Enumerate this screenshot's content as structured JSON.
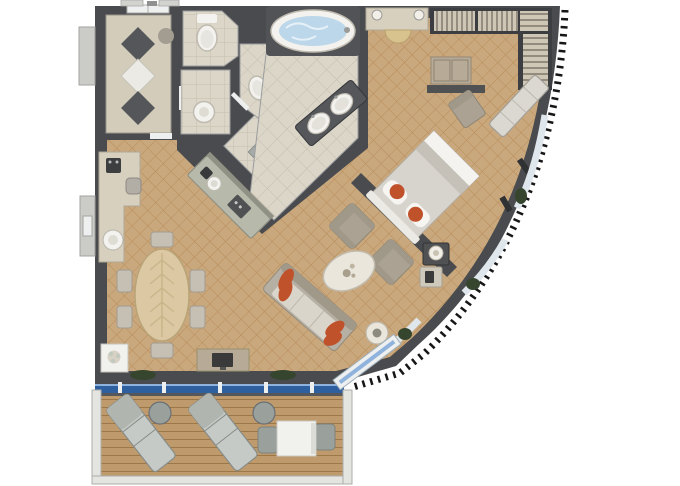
{
  "page": {
    "kind": "cruise-suite-floor-plan",
    "background": "#ffffff"
  },
  "colors": {
    "wall": "#494b4e",
    "wallDark": "#3c3e41",
    "carpet": "#c9a87e",
    "carpetLine": "#b5854d",
    "tile": "#dbd6c8",
    "tileLine": "#c4beae",
    "hallFloor": "#d3ccba",
    "diamondDark": "#54565a",
    "diamondLight": "#eceae4",
    "fixture": "#f3f2ee",
    "fixtureEdge": "#bfbbb0",
    "water": "#bcd7e9",
    "waterSwirl": "#e9f3f9",
    "counterBar": "#b7b9ab",
    "counterEdge": "#8f9184",
    "sinkCounter": "#55575a",
    "marble": "#d8d0be",
    "marbleEdge": "#b0a896",
    "stool": "#d8c28e",
    "closetFloor": "#cfc7b6",
    "closetLine": "#6e675c",
    "deskWood": "#b7ab98",
    "shelfDark": "#4f5153",
    "bedDuvet": "#d7d4cd",
    "bedFold": "#f4f3f0",
    "bedThrow": "#c6c1b8",
    "pillow": "#f6f5f2",
    "headboard": "#eceae5",
    "orange": "#c0522b",
    "sofa": "#b6afa3",
    "sofaDark": "#a09888",
    "sofaSeat": "#d9d5ca",
    "chairGray": "#aba294",
    "coffeeTable": "#eae6dc",
    "woodDeck": "#bf9a6c",
    "deckLine": "#9c7747",
    "glass": "#2e5f9e",
    "glassLight": "#8fb3dc",
    "windowPane": "#dfe7ec",
    "frameWhite": "#eef0f0",
    "railing": "#e4e4e1",
    "railingEdge": "#adadaa",
    "lounger": "#c6cac6",
    "loungerEdge": "#878c88",
    "loungerBack": "#b0b5b0",
    "outdoorGray": "#9aa09c",
    "tableWhite": "#f1f1ee",
    "plant": "#36452e",
    "tvDark": "#3a3a3a",
    "lamp": "#f1efe8",
    "metal": "#9a9a98",
    "tickBlack": "#161616",
    "diningWood": "#dcc9a4",
    "diningWoodLine": "#c9b488",
    "chairLight": "#c6c0b4",
    "chairEdge": "#a29c90",
    "exteriorGray": "#cbcbc8",
    "exteriorEdge": "#a3a3a0"
  },
  "floor_plan": {
    "rooms": [
      {
        "name": "entry-hall",
        "features": [
          "inlaid-marble-floor",
          "double-entry-door"
        ]
      },
      {
        "name": "wc-room",
        "features": [
          "toilet"
        ]
      },
      {
        "name": "powder-room",
        "features": [
          "washbasin"
        ]
      },
      {
        "name": "shower-room",
        "features": [
          "floor-drain"
        ]
      },
      {
        "name": "bidet-room",
        "features": [
          "bidet"
        ]
      },
      {
        "name": "master-bathroom",
        "features": [
          "whirlpool-bathtub",
          "double-sink-vanity"
        ]
      },
      {
        "name": "walk-in-closet",
        "features": [
          "hanging-rails",
          "shelving"
        ]
      },
      {
        "name": "bedroom",
        "features": [
          "king-bed",
          "vanity-counter",
          "vanity-stool",
          "desk",
          "desk-chair",
          "window-bench",
          "nightstand",
          "table-lamp",
          "telephone-table"
        ]
      },
      {
        "name": "living-room",
        "features": [
          "sofa",
          "orange-throw-pillows",
          "armchair",
          "armchair",
          "marble-coffee-table",
          "side-table",
          "tv-console",
          "tv",
          "decor-cabinet"
        ]
      },
      {
        "name": "dining-area",
        "features": [
          "oval-dining-table",
          "six-dining-chairs",
          "wet-bar-counter",
          "sideboard-counter",
          "espresso-machine",
          "bar-stool",
          "bar-sink"
        ]
      },
      {
        "name": "balcony",
        "features": [
          "teak-deck",
          "sun-lounger",
          "sun-lounger",
          "round-side-table",
          "round-side-table",
          "outdoor-table",
          "outdoor-chair",
          "outdoor-chair",
          "glass-balustrade"
        ]
      }
    ],
    "counts": {
      "sun_loungers": 2,
      "armchairs": 2,
      "dining_chairs": 6,
      "toilets": 2,
      "sinks": 3
    }
  }
}
